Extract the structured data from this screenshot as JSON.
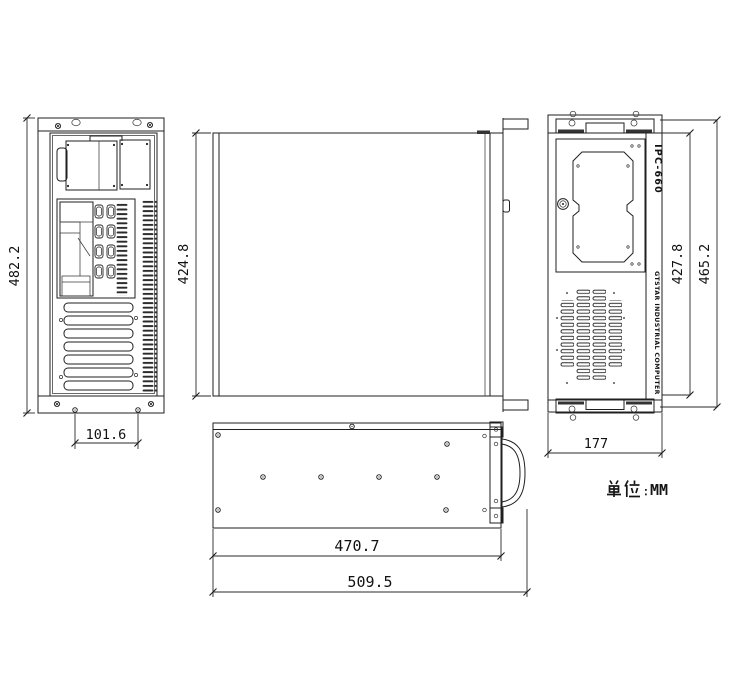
{
  "drawing": {
    "unit_label": "单位：MM",
    "unit_value": "MM",
    "front_panel": {
      "model_text": "IPC-660",
      "brand_text": "GTSTAR INDUSTRIAL COMPUTER"
    },
    "dimensions": {
      "rear_overall_height": "482.2",
      "chassis_body_height": "424.8",
      "rear_bottom_hole_spacing": "101.6",
      "front_inner_width": "427.8",
      "front_overall_width": "465.2",
      "front_depth": "177",
      "side_body_length": "470.7",
      "side_overall_length": "509.5"
    }
  }
}
